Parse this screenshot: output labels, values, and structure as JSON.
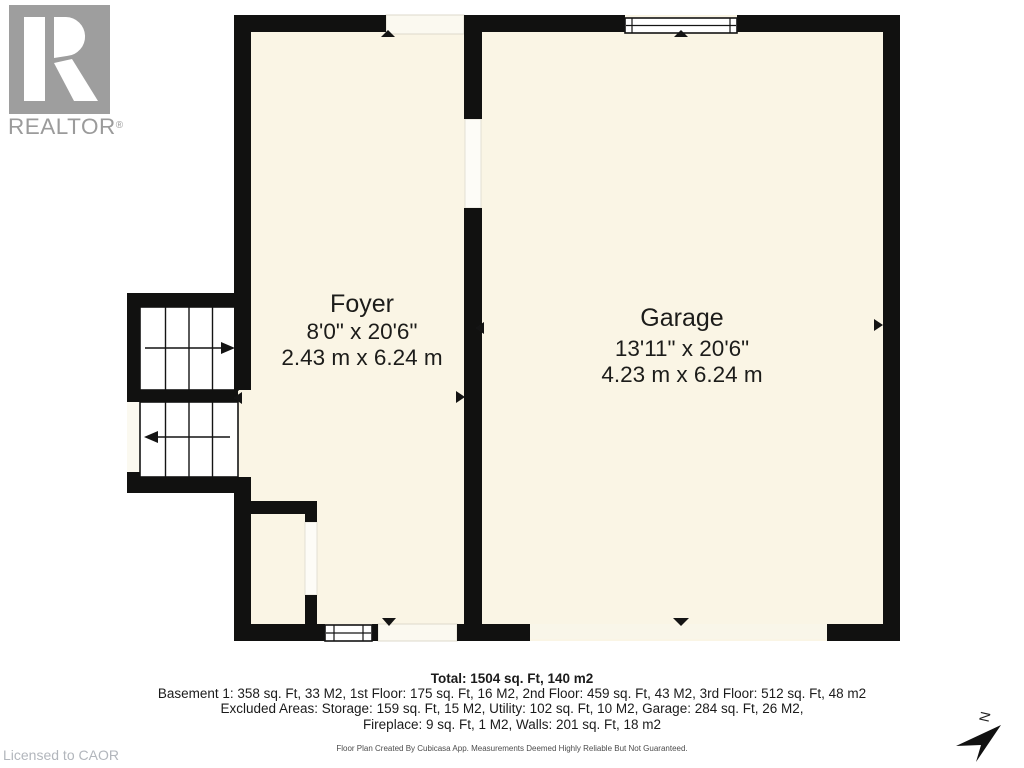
{
  "branding": {
    "logo_text": "REALTOR",
    "registered_mark": "®"
  },
  "license": {
    "text": "Licensed to CAOR"
  },
  "floorplan": {
    "rooms": [
      {
        "name": "Foyer",
        "dimensions_imperial": "8'0\" x 20'6\"",
        "dimensions_metric": "2.43 m x 6.24 m"
      },
      {
        "name": "Garage",
        "dimensions_imperial": "13'11\" x 20'6\"",
        "dimensions_metric": "4.23 m x 6.24 m"
      }
    ],
    "compass_label": "N"
  },
  "summary": {
    "total": "Total: 1504 sq. Ft, 140 m2",
    "floors": "Basement 1: 358 sq. Ft, 33 M2, 1st Floor: 175 sq. Ft, 16 M2, 2nd Floor: 459 sq. Ft, 43 M2, 3rd Floor: 512 sq. Ft, 48 m2",
    "excluded_line1": "Excluded Areas: Storage: 159 sq. Ft, 15 M2, Utility: 102 sq. Ft, 10 M2, Garage: 284 sq. Ft, 26 M2,",
    "excluded_line2": "Fireplace: 9 sq. Ft, 1 M2, Walls: 201 sq. Ft, 18 m2"
  },
  "disclaimer": "Floor Plan Created By Cubicasa App. Measurements Deemed Highly Reliable But Not Guaranteed.",
  "colors": {
    "floor_fill": "#FAF5E5",
    "threshold_fill": "#FBF9F0",
    "recess_fill": "#FDFCF7",
    "wall": "#111110",
    "logo_gray": "#9E9E9E",
    "license_gray": "#B2B6BC",
    "text_dark": "#1C1C1A"
  }
}
